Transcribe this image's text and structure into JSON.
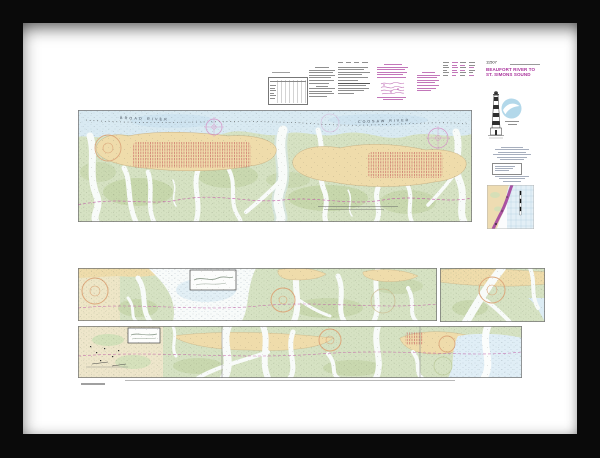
{
  "artwork": {
    "frame_color": "#0a0a0a",
    "mat_color": "#ffffff",
    "paper_color": "#ffffff"
  },
  "title_block": {
    "chart_number": "11507",
    "title_line1": "BEAUFORT RIVER TO",
    "title_line2": "ST. SIMONS SOUND",
    "title_color": "#a9309b",
    "logo_icon": "noaa-logo",
    "illustration_icon": "lighthouse-sketch"
  },
  "upper_strip": {
    "river_label_left": "BROAD RIVER",
    "river_label_right": "COOSAW RIVER"
  },
  "palette": {
    "marsh_green": "#d6e2c3",
    "dark_marsh_green": "#c3d4a6",
    "land_tan": "#efdcab",
    "water_blue": "#d9eaf2",
    "channel_white": "#f8fbf9",
    "magenta_accent": "#c25ba8",
    "compass_orange": "#dca87c",
    "hatch_red": "#cb6d66",
    "noaa_blue": "#b3d8ea"
  }
}
